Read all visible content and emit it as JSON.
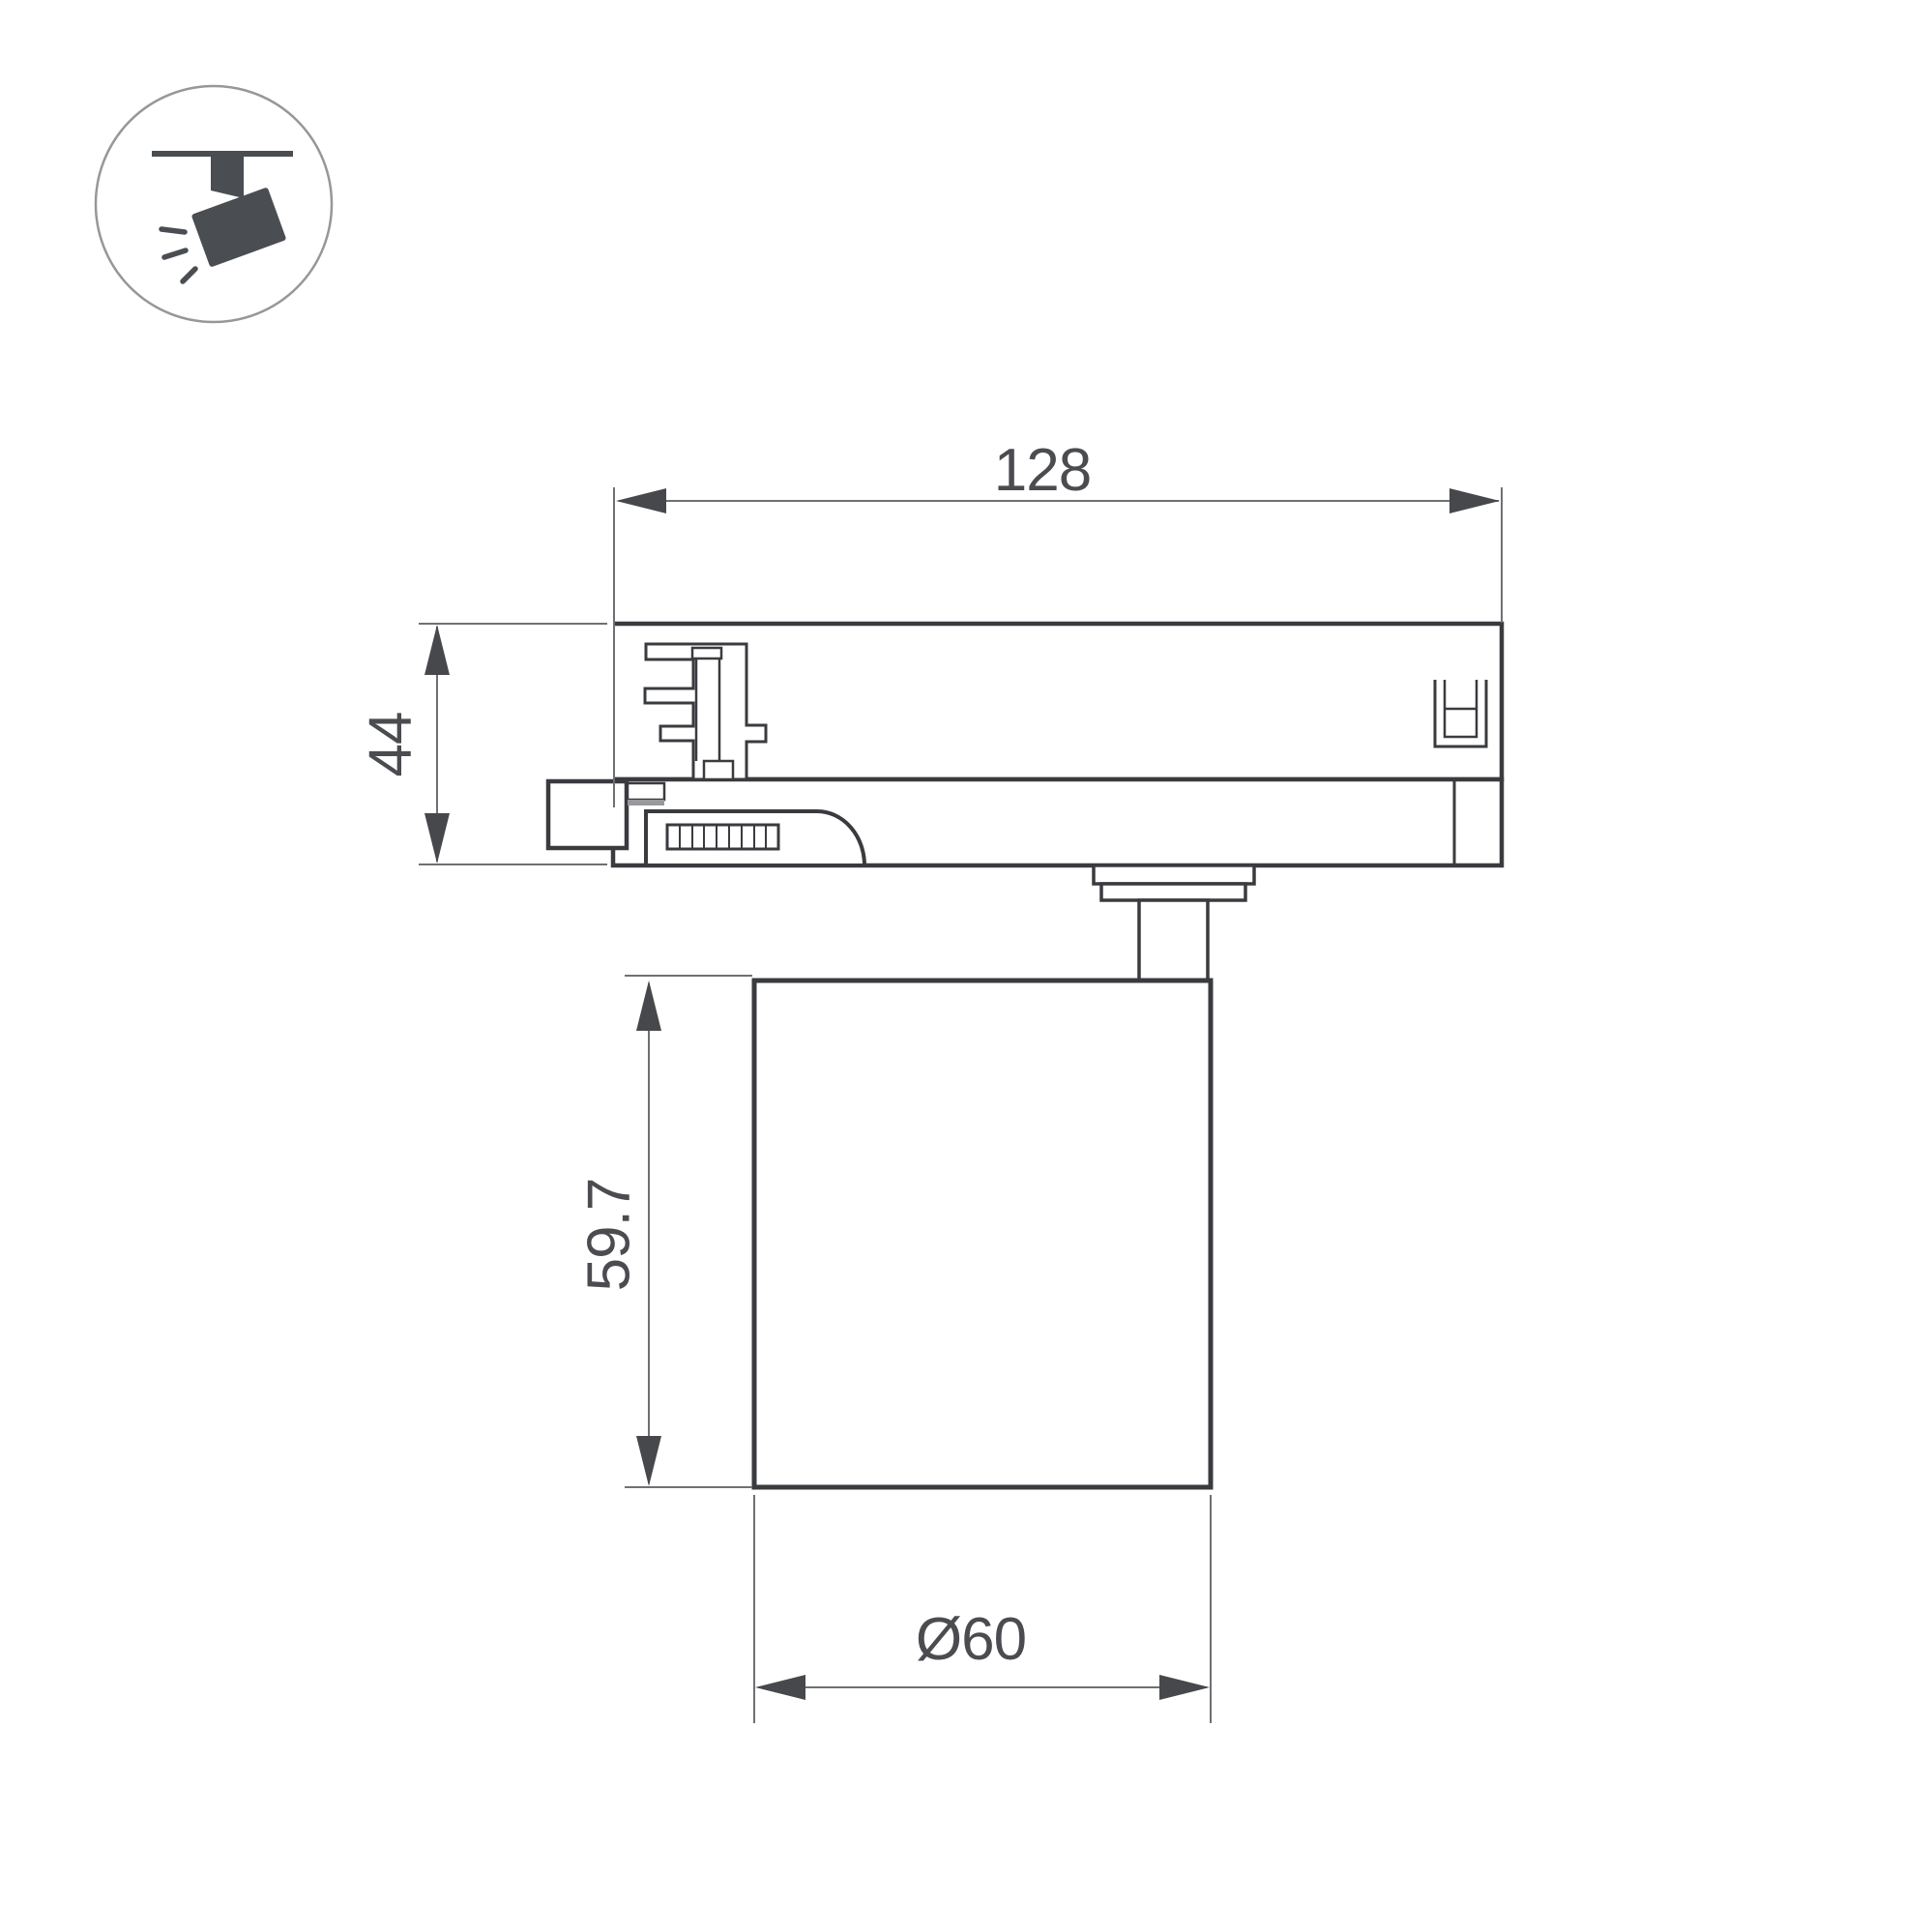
{
  "document": {
    "type": "technical-dimension-drawing",
    "subject": "track-light-fixture-side-view",
    "background": "#ffffff"
  },
  "icon": {
    "name": "track-spotlight",
    "description": "ceiling track with tilted spotlight and light rays inside a circle badge",
    "color": "#4a4e53",
    "circle_color": "#95979a"
  },
  "dimensions": {
    "track_adapter_width": "128",
    "track_adapter_height": "44",
    "lamp_body_height": "59.7",
    "lamp_body_diameter": "Ø60"
  },
  "colors": {
    "part_outline": "#3a3b3f",
    "dimension_line": "#6f7073",
    "arrow": "#47484c",
    "dimension_text": "#4b4c50"
  }
}
